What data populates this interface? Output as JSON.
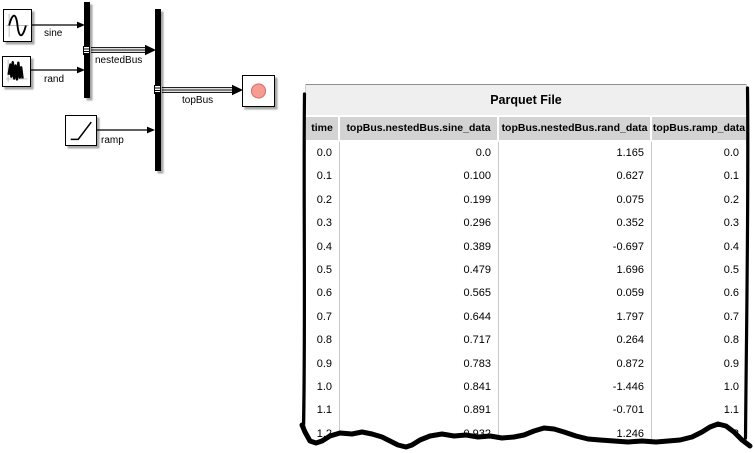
{
  "diagram": {
    "labels": {
      "sine": "sine",
      "rand": "rand",
      "ramp": "ramp",
      "nestedBus": "nestedBus",
      "topBus": "topBus"
    },
    "record_dot_color": "#f59c95"
  },
  "table": {
    "title": "Parquet File",
    "columns": [
      "time",
      "topBus.nestedBus.sine_data",
      "topBus.nestedBus.rand_data",
      "topBus.ramp_data"
    ],
    "rows": [
      [
        "0.0",
        "0.0",
        "1.165",
        "0.0"
      ],
      [
        "0.1",
        "0.100",
        "0.627",
        "0.1"
      ],
      [
        "0.2",
        "0.199",
        "0.075",
        "0.2"
      ],
      [
        "0.3",
        "0.296",
        "0.352",
        "0.3"
      ],
      [
        "0.4",
        "0.389",
        "-0.697",
        "0.4"
      ],
      [
        "0.5",
        "0.479",
        "1.696",
        "0.5"
      ],
      [
        "0.6",
        "0.565",
        "0.059",
        "0.6"
      ],
      [
        "0.7",
        "0.644",
        "1.797",
        "0.7"
      ],
      [
        "0.8",
        "0.717",
        "0.264",
        "0.8"
      ],
      [
        "0.9",
        "0.783",
        "0.872",
        "0.9"
      ],
      [
        "1.0",
        "0.841",
        "-1.446",
        "1.0"
      ],
      [
        "1.1",
        "0.891",
        "-0.701",
        "1.1"
      ],
      [
        "1.2",
        "0.932",
        "1.246",
        "1.2"
      ]
    ]
  }
}
